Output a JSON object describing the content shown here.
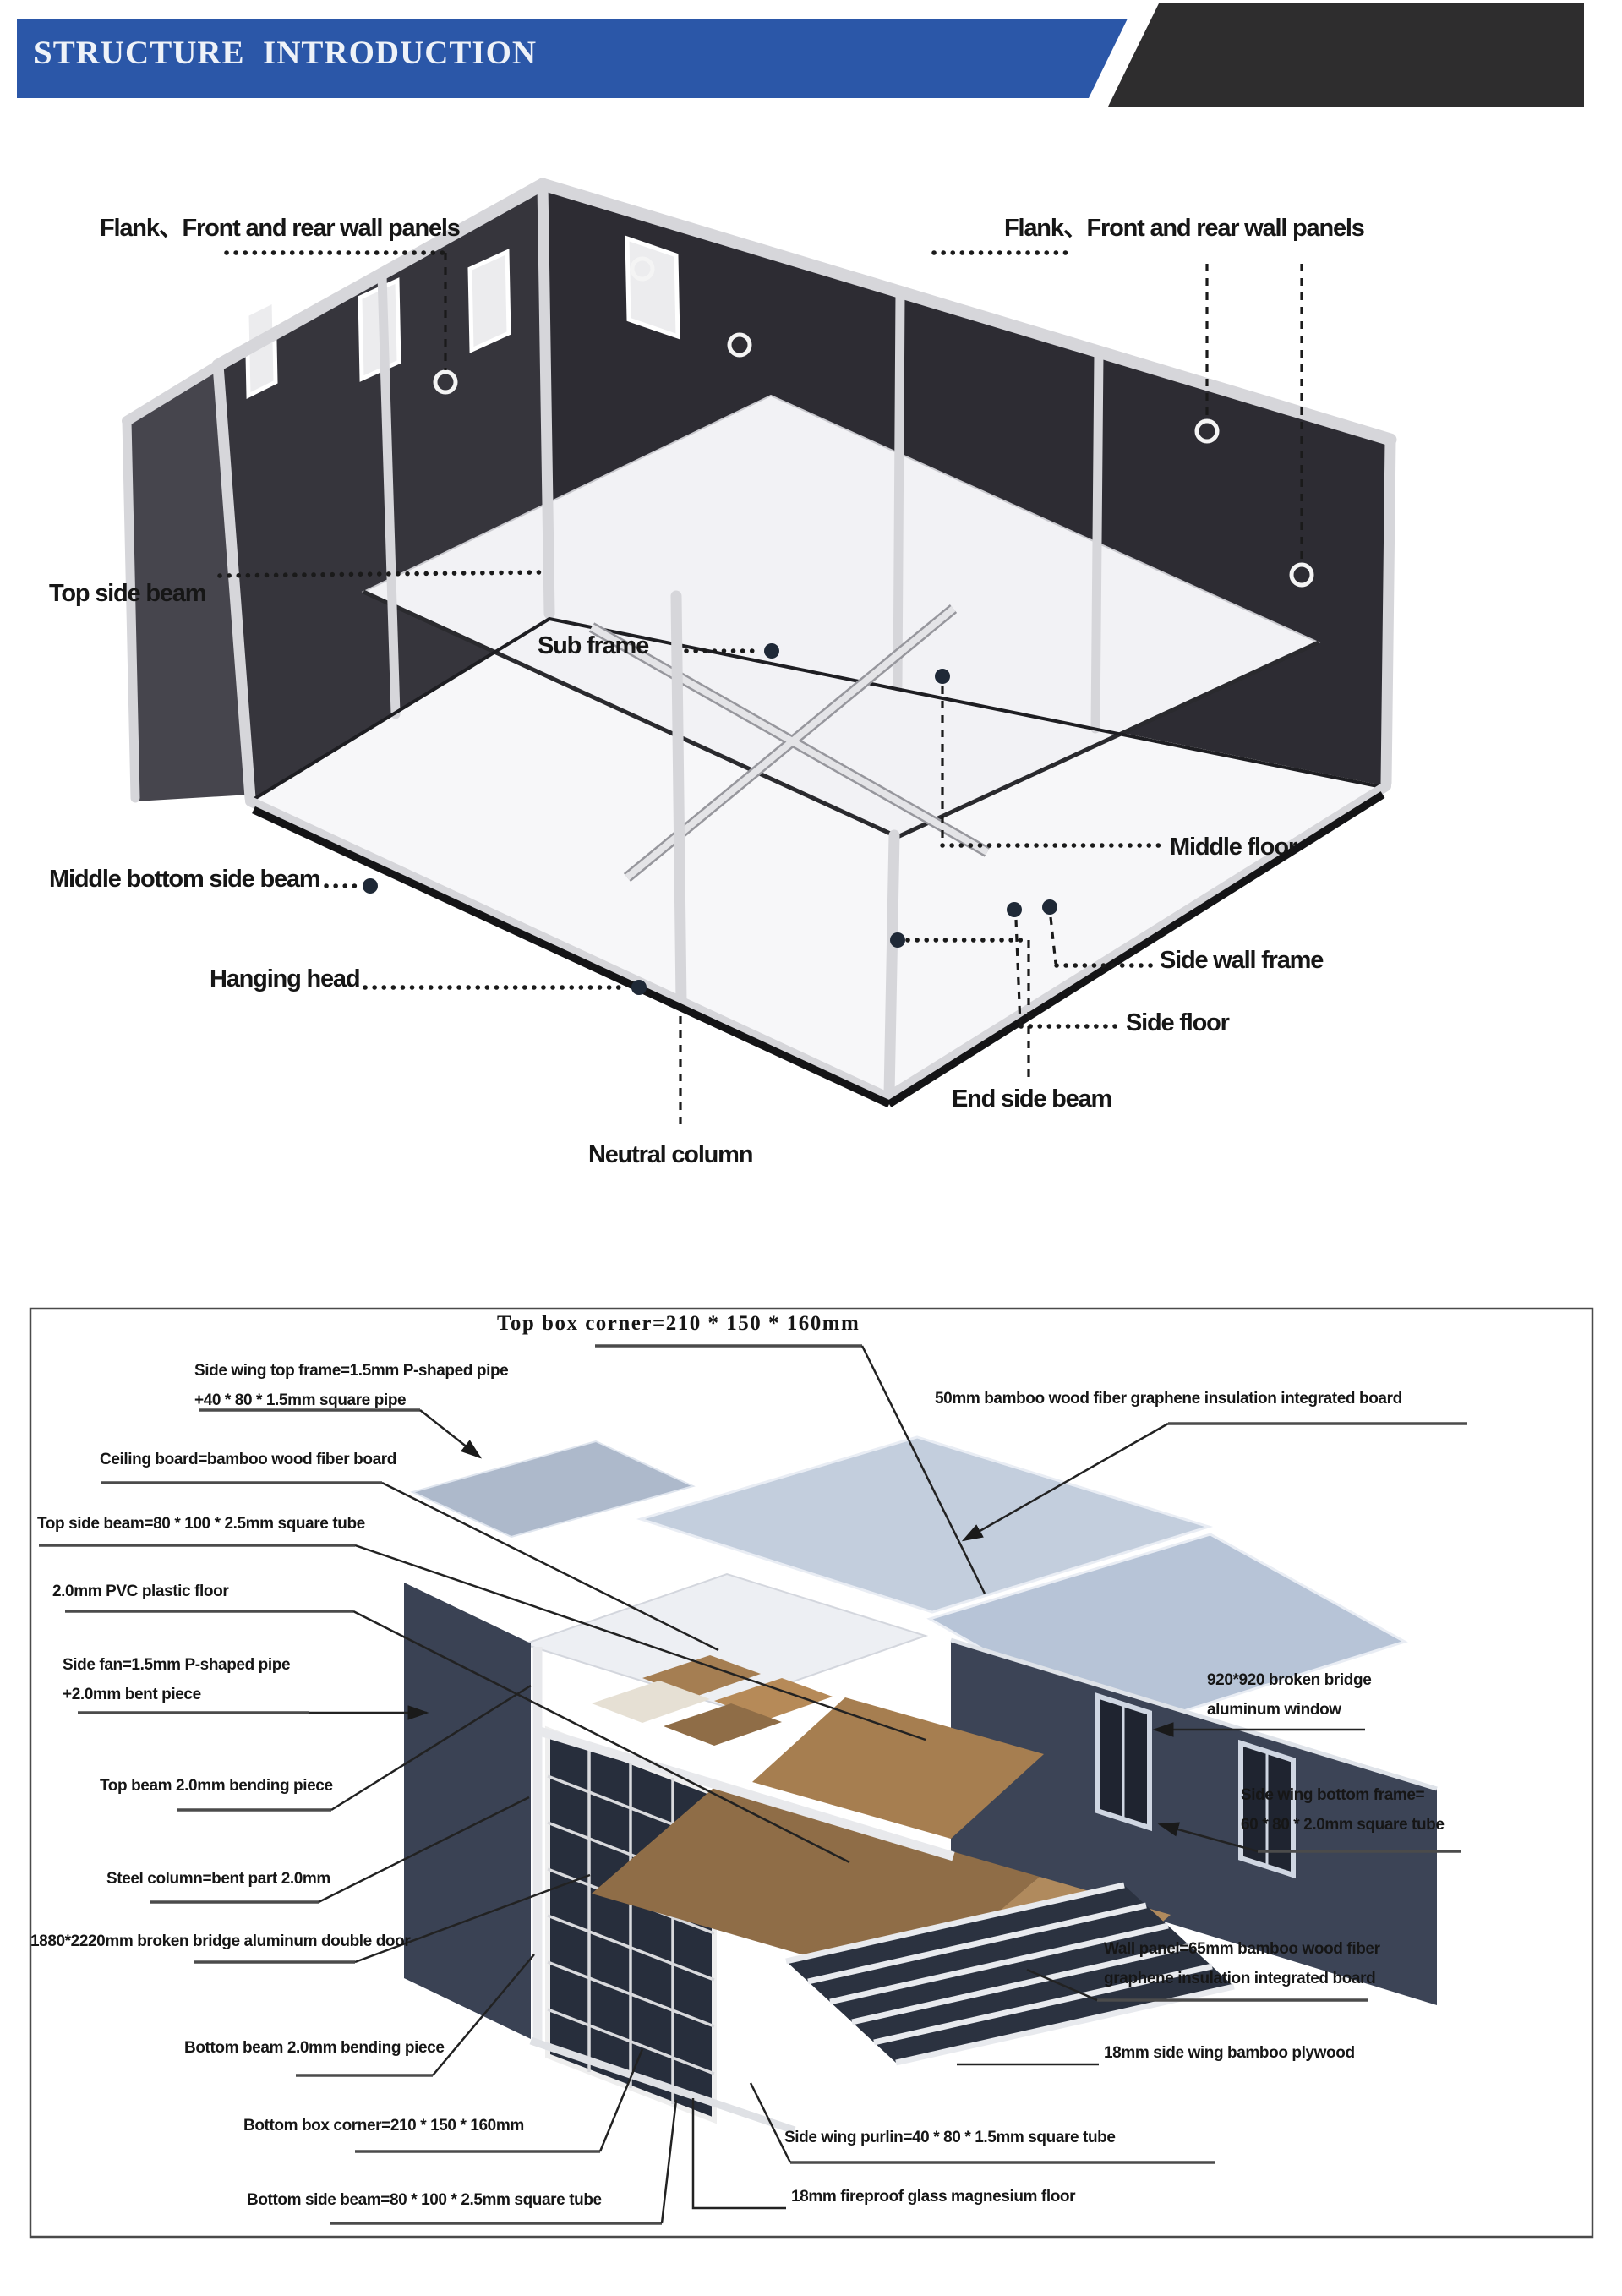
{
  "header": {
    "title": "STRUCTURE  INTRODUCTION"
  },
  "colors": {
    "header-blue": "#2b57a8",
    "header-dark": "#2e2d2e",
    "wall-dark": "#36353c",
    "roof-blue": "#c3cedd",
    "floor-brown": "#8f6d47",
    "label-ink": "#161616"
  },
  "diagram1": {
    "labels": {
      "flank_left": "Flank、Front and rear wall panels",
      "flank_right": "Flank、Front and rear wall panels",
      "top_side_beam": "Top side beam",
      "sub_frame": "Sub frame",
      "middle_bottom_side_beam": "Middle bottom side beam",
      "hanging_head": "Hanging head",
      "middle_floor": "Middle floor",
      "side_wall_frame": "Side wall frame",
      "side_floor": "Side floor",
      "end_side_beam": "End side beam",
      "neutral_column": "Neutral column"
    }
  },
  "diagram2": {
    "labels": {
      "top_box_corner": "Top box corner=210 * 150 * 160mm",
      "side_wing_top_frame_1": "Side wing top frame=1.5mm P-shaped pipe",
      "side_wing_top_frame_2": "+40 * 80 * 1.5mm square pipe",
      "ceiling_board": "Ceiling board=bamboo wood fiber board",
      "top_side_beam": "Top side beam=80 * 100 * 2.5mm square tube",
      "pvc_floor": "2.0mm PVC plastic floor",
      "side_fan_1": "Side fan=1.5mm P-shaped pipe",
      "side_fan_2": "+2.0mm bent piece",
      "top_beam_bending": "Top beam 2.0mm bending piece",
      "steel_column": "Steel column=bent part 2.0mm",
      "double_door": "1880*2220mm broken bridge aluminum double door",
      "bottom_beam_bending": "Bottom beam 2.0mm bending piece",
      "bottom_box_corner": "Bottom box corner=210 * 150 * 160mm",
      "bottom_side_beam": "Bottom side beam=80 * 100 * 2.5mm square tube",
      "insulation_50mm": "50mm bamboo wood fiber graphene insulation integrated board",
      "window_920_1": "920*920 broken bridge",
      "window_920_2": "aluminum window",
      "side_wing_bottom_frame_1": "Side wing bottom frame=",
      "side_wing_bottom_frame_2": "60 * 80 * 2.0mm square tube",
      "wall_panel_1": "Wall panel=65mm bamboo wood fiber",
      "wall_panel_2": "graphene insulation integrated board",
      "plywood_18mm": "18mm side wing bamboo plywood",
      "side_wing_purlin": "Side wing purlin=40 * 80 * 1.5mm square tube",
      "fireproof_floor": "18mm fireproof glass magnesium floor"
    }
  }
}
